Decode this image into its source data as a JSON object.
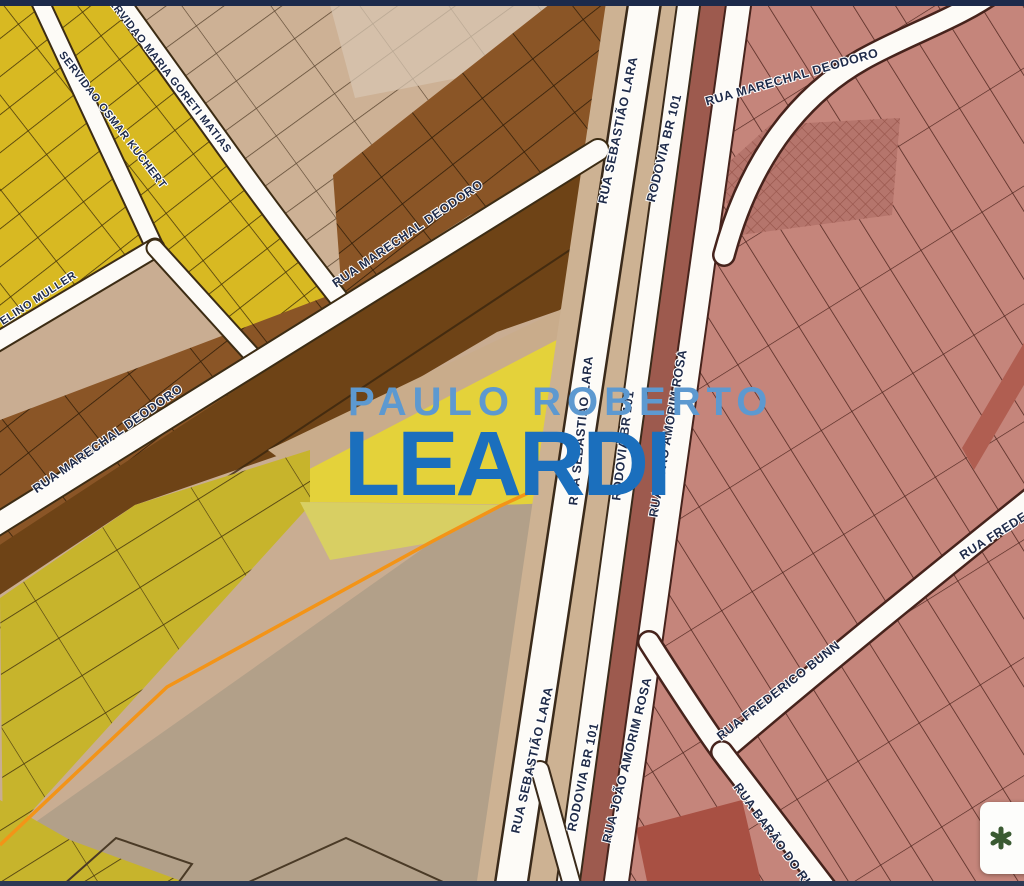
{
  "watermark": {
    "line1": "PAULO ROBERTO",
    "line2": "LEARDI",
    "line1_color": "#5d99d0",
    "line2_color": "#1b6fbd"
  },
  "streets": {
    "servidao_maria_goreti_matias": "SERVIDAO MARIA GORETI MATIAS",
    "servidao_osmar_kuchert": "SERVIDAO OSMAR KUCHERT",
    "muller": "ELINO MULLER",
    "marechal_deodoro": "RUA MARECHAL DEODORO",
    "sebastiao_lara": "RUA SEBASTIÃO LARA",
    "rodovia_br101": "RODOVIA BR 101",
    "joao_amorim_rosa": "RUA JOÃO AMORIM ROSA",
    "frederico_bunn": "RUA FREDERICO BUNN",
    "frederico_truncated": "RUA FREDERI",
    "barao_do_rio_truncated": "RUA BARÃO DO RIO B"
  },
  "colors": {
    "yellow_parcels": "#d8b922",
    "bright_yellow_parcel": "#e4d23a",
    "olive_parcels": "#c7b42c",
    "tan_parcels": "#cdb195",
    "brown_parcels": "#8a5526",
    "dark_brown_parcel": "#6e4316",
    "pink_parcels": "#c5857b",
    "highway_band": "#9d5a4e",
    "road_fill": "#fdfbf7",
    "orange_boundary": "#f39417",
    "label_text": "#1f2b49",
    "edge_strip": "#1c2a4b"
  }
}
